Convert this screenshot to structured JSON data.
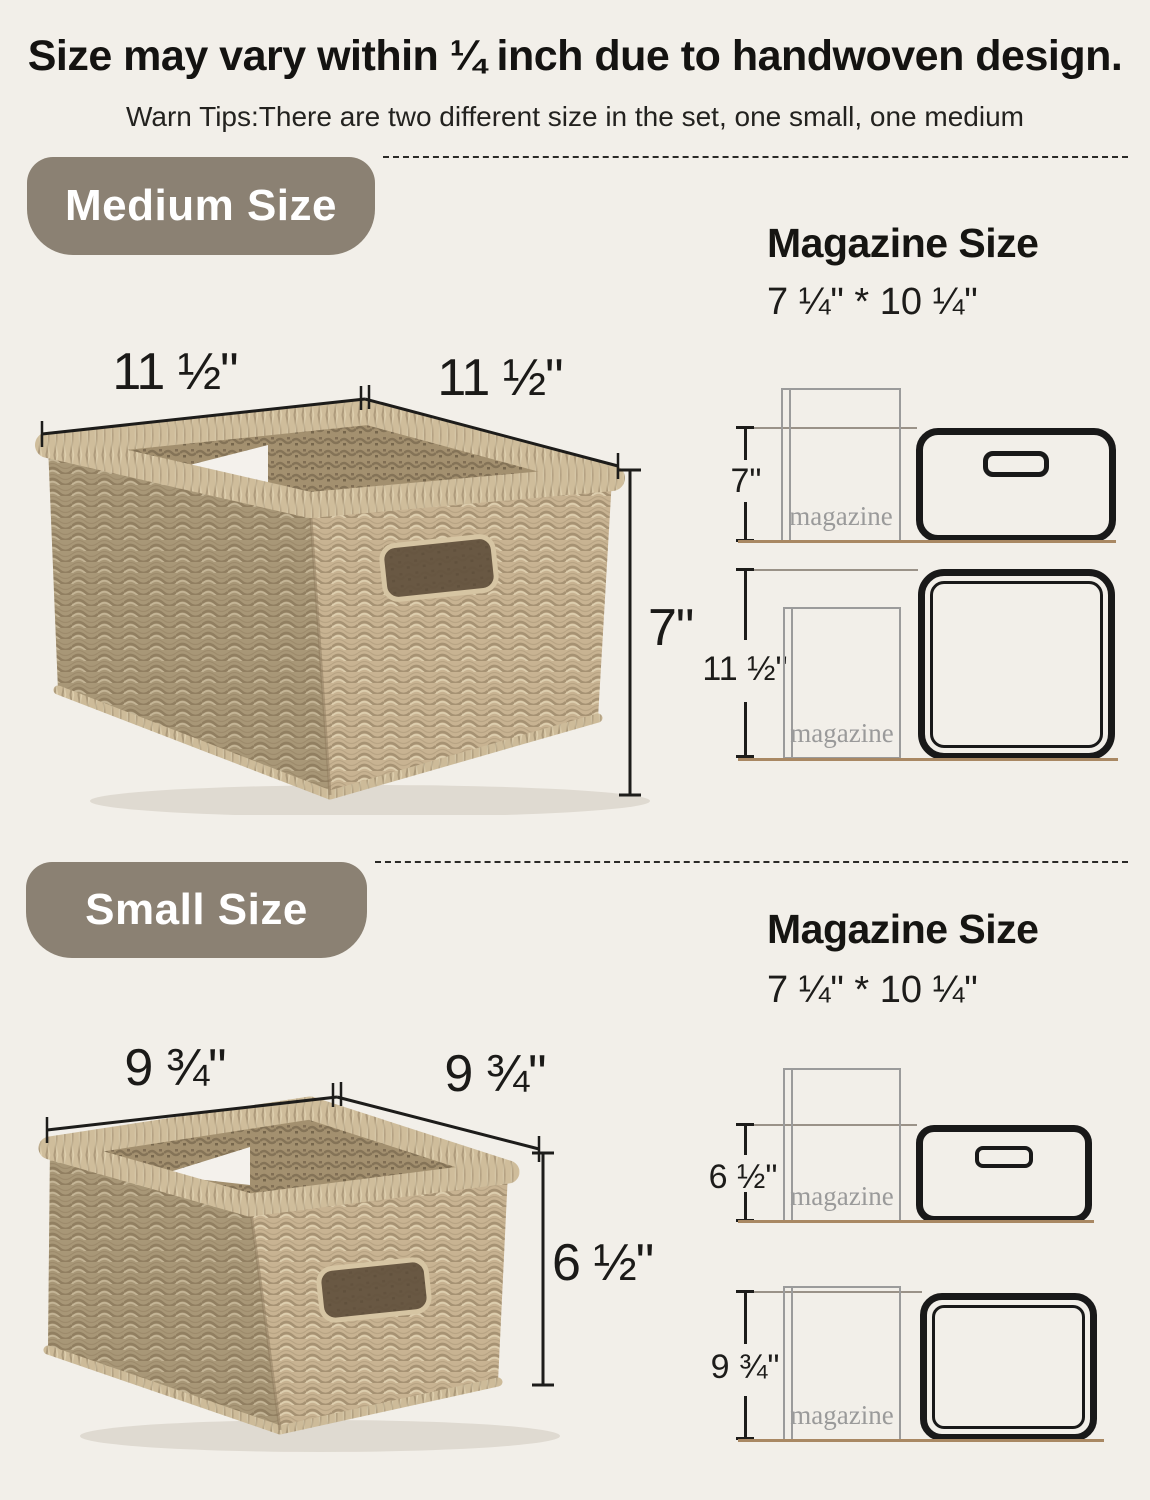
{
  "header": {
    "title": "Size may vary within ¼ inch due to handwoven design.",
    "subtitle": "Warn Tips:There are two different size in the set, one small, one medium"
  },
  "colors": {
    "background": "#F2EFE9",
    "badge": "#8B8173",
    "ink": "#1D1C1A",
    "baseline_tan": "#A98863",
    "magazine_outline": "#9B9B9B",
    "basket_tan": "#C8B392"
  },
  "sections": [
    {
      "id": "medium",
      "badge_label": "Medium Size",
      "magazine": {
        "heading": "Magazine Size",
        "size_text": "7 ¼\" * 10 ¼\"",
        "label": "magazine"
      },
      "photo_dims": {
        "width": "11 ½\"",
        "depth": "11 ½\"",
        "height": "7\""
      },
      "diagram_side": {
        "height_label": "7\""
      },
      "diagram_top": {
        "width_label": "11 ½\""
      }
    },
    {
      "id": "small",
      "badge_label": "Small Size",
      "magazine": {
        "heading": "Magazine Size",
        "size_text": "7 ¼\" * 10 ¼\"",
        "label": "magazine"
      },
      "photo_dims": {
        "width": "9 ¾\"",
        "depth": "9 ¾\"",
        "height": "6 ½\""
      },
      "diagram_side": {
        "height_label": "6 ½\""
      },
      "diagram_top": {
        "width_label": "9 ¾\""
      }
    }
  ]
}
